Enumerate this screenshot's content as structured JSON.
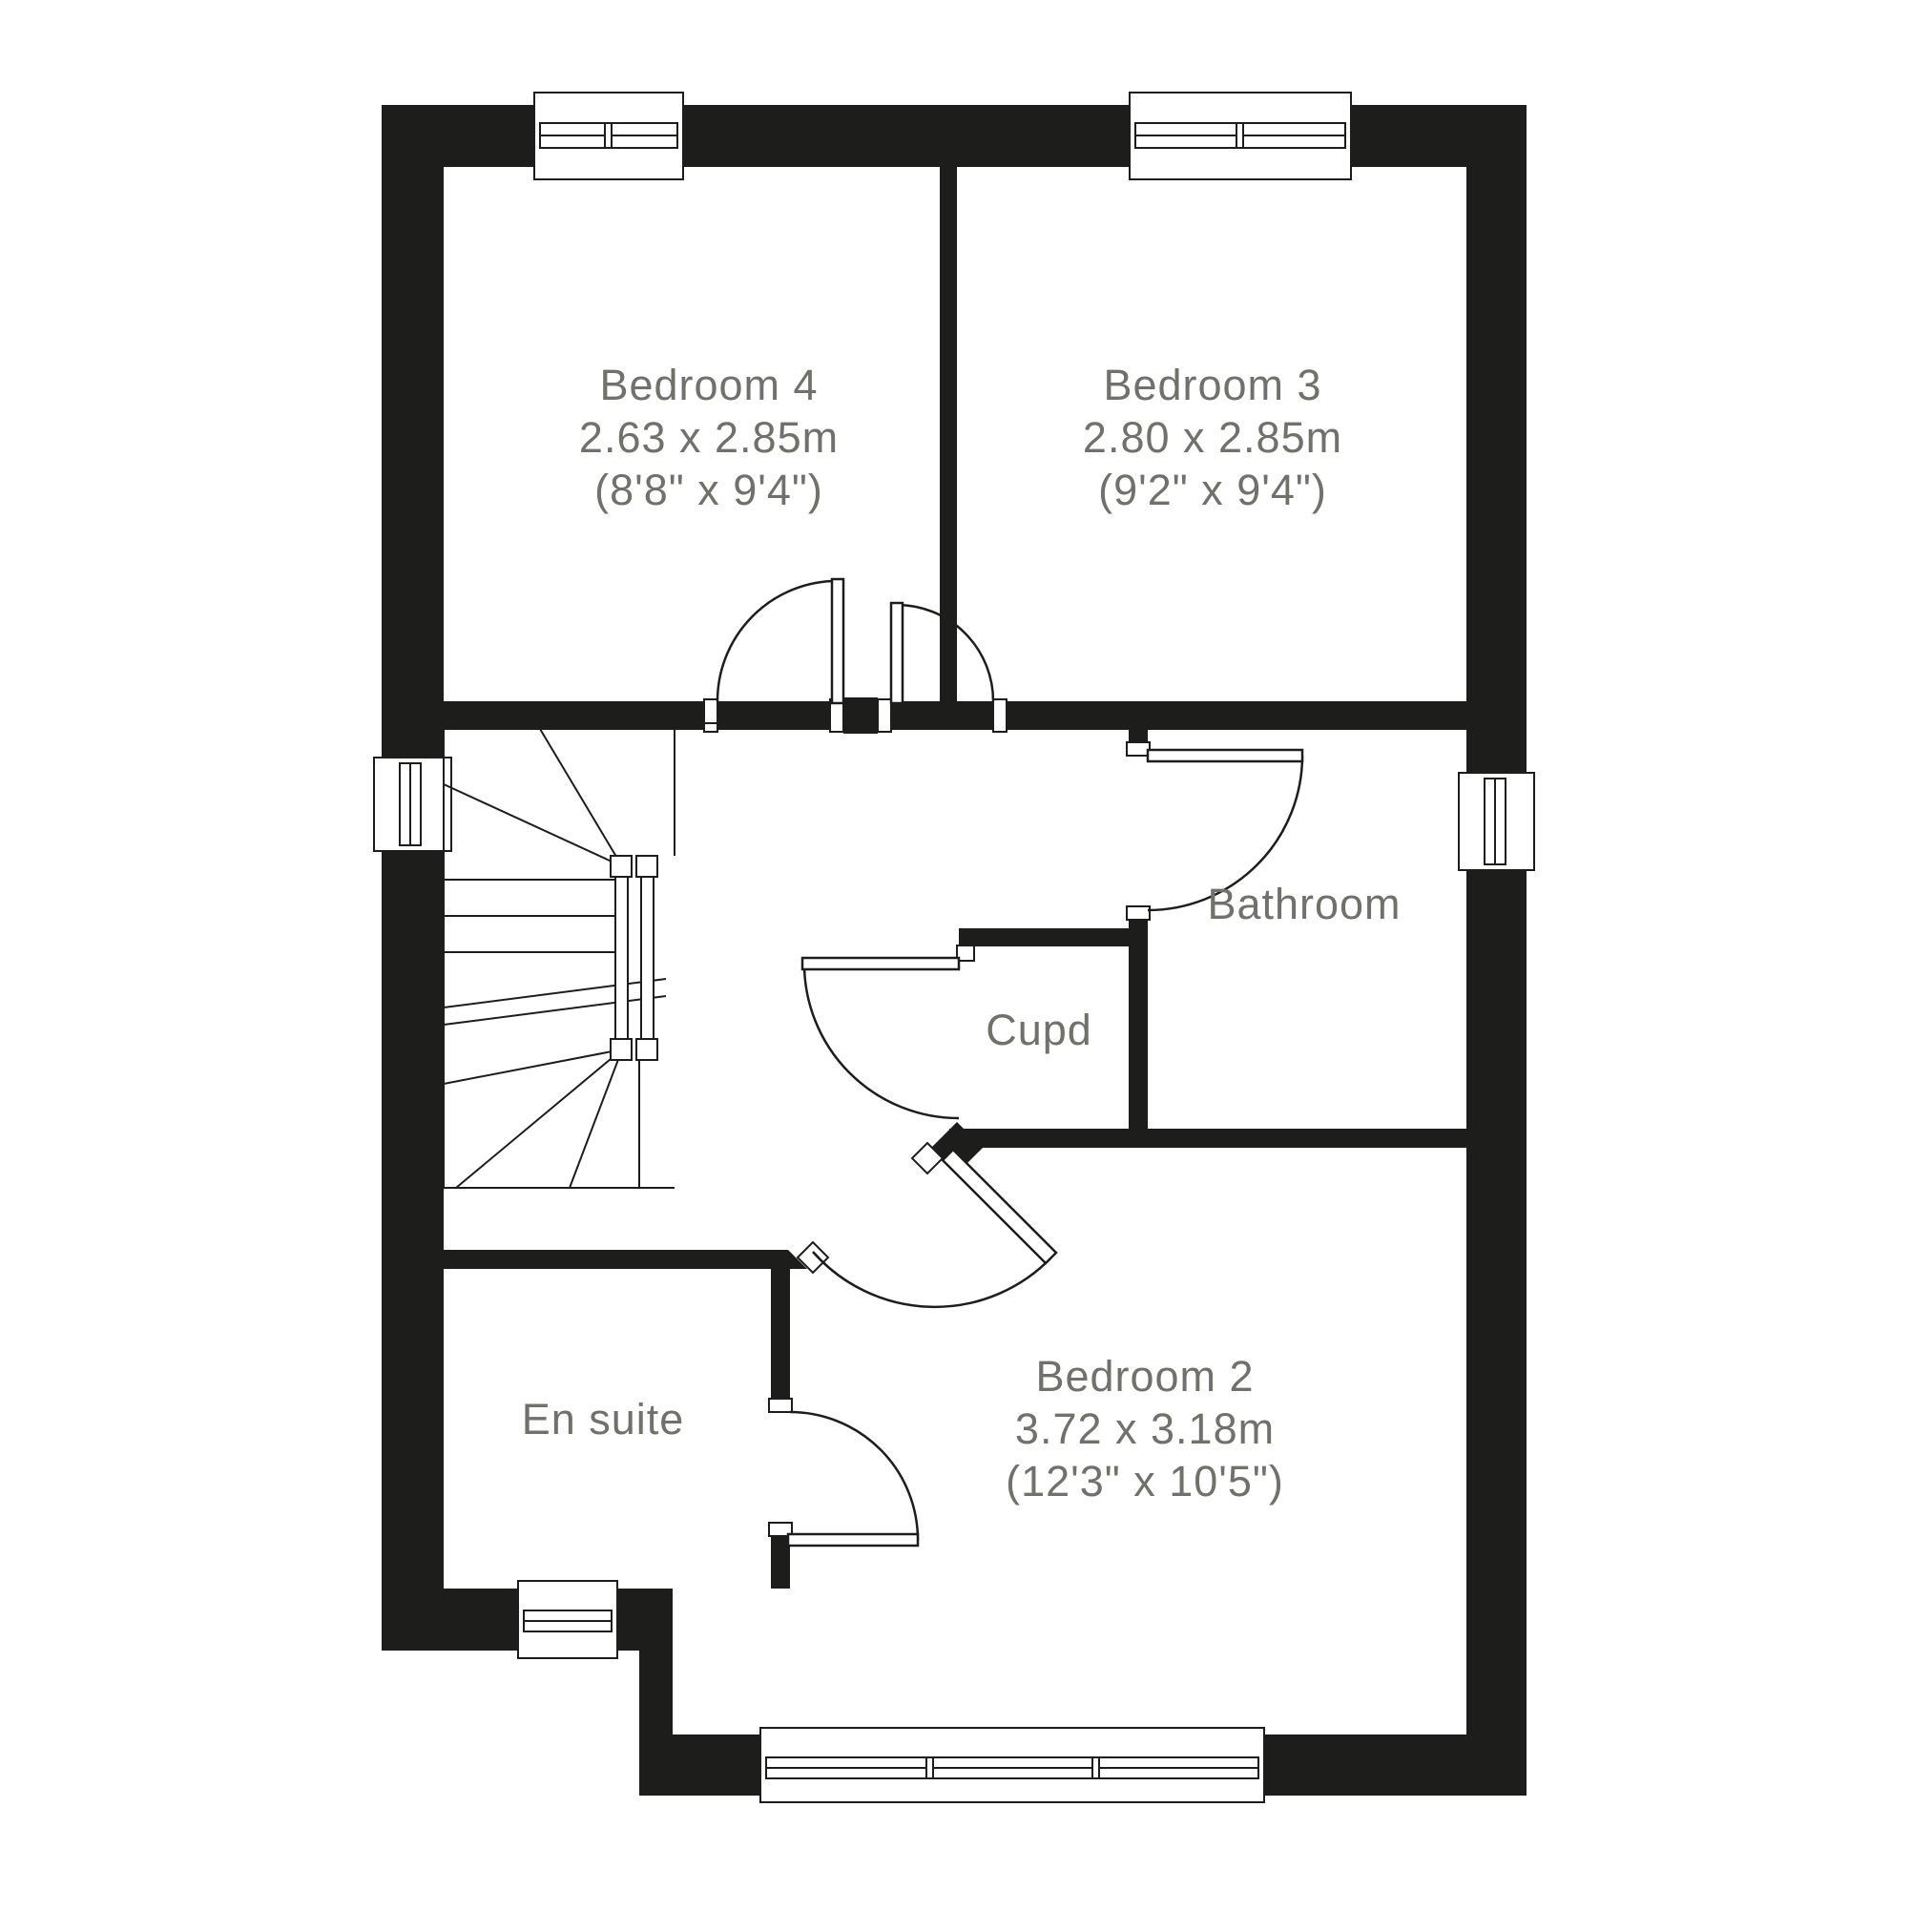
{
  "plan": {
    "rooms": [
      {
        "name": "Bedroom 4",
        "size_metric": "2.63 x 2.85m",
        "size_imperial": "(8'8\" x 9'4\")"
      },
      {
        "name": "Bedroom 3",
        "size_metric": "2.80 x 2.85m",
        "size_imperial": "(9'2\" x 9'4\")"
      },
      {
        "name": "Bathroom"
      },
      {
        "name": "Cupd"
      },
      {
        "name": "En suite"
      },
      {
        "name": "Bedroom 2",
        "size_metric": "3.72 x 3.18m",
        "size_imperial": "(12'3\" x 10'5\")"
      }
    ],
    "colors": {
      "wall": "#1d1d1b",
      "label_text": "#70716a",
      "background": "#ffffff"
    }
  }
}
